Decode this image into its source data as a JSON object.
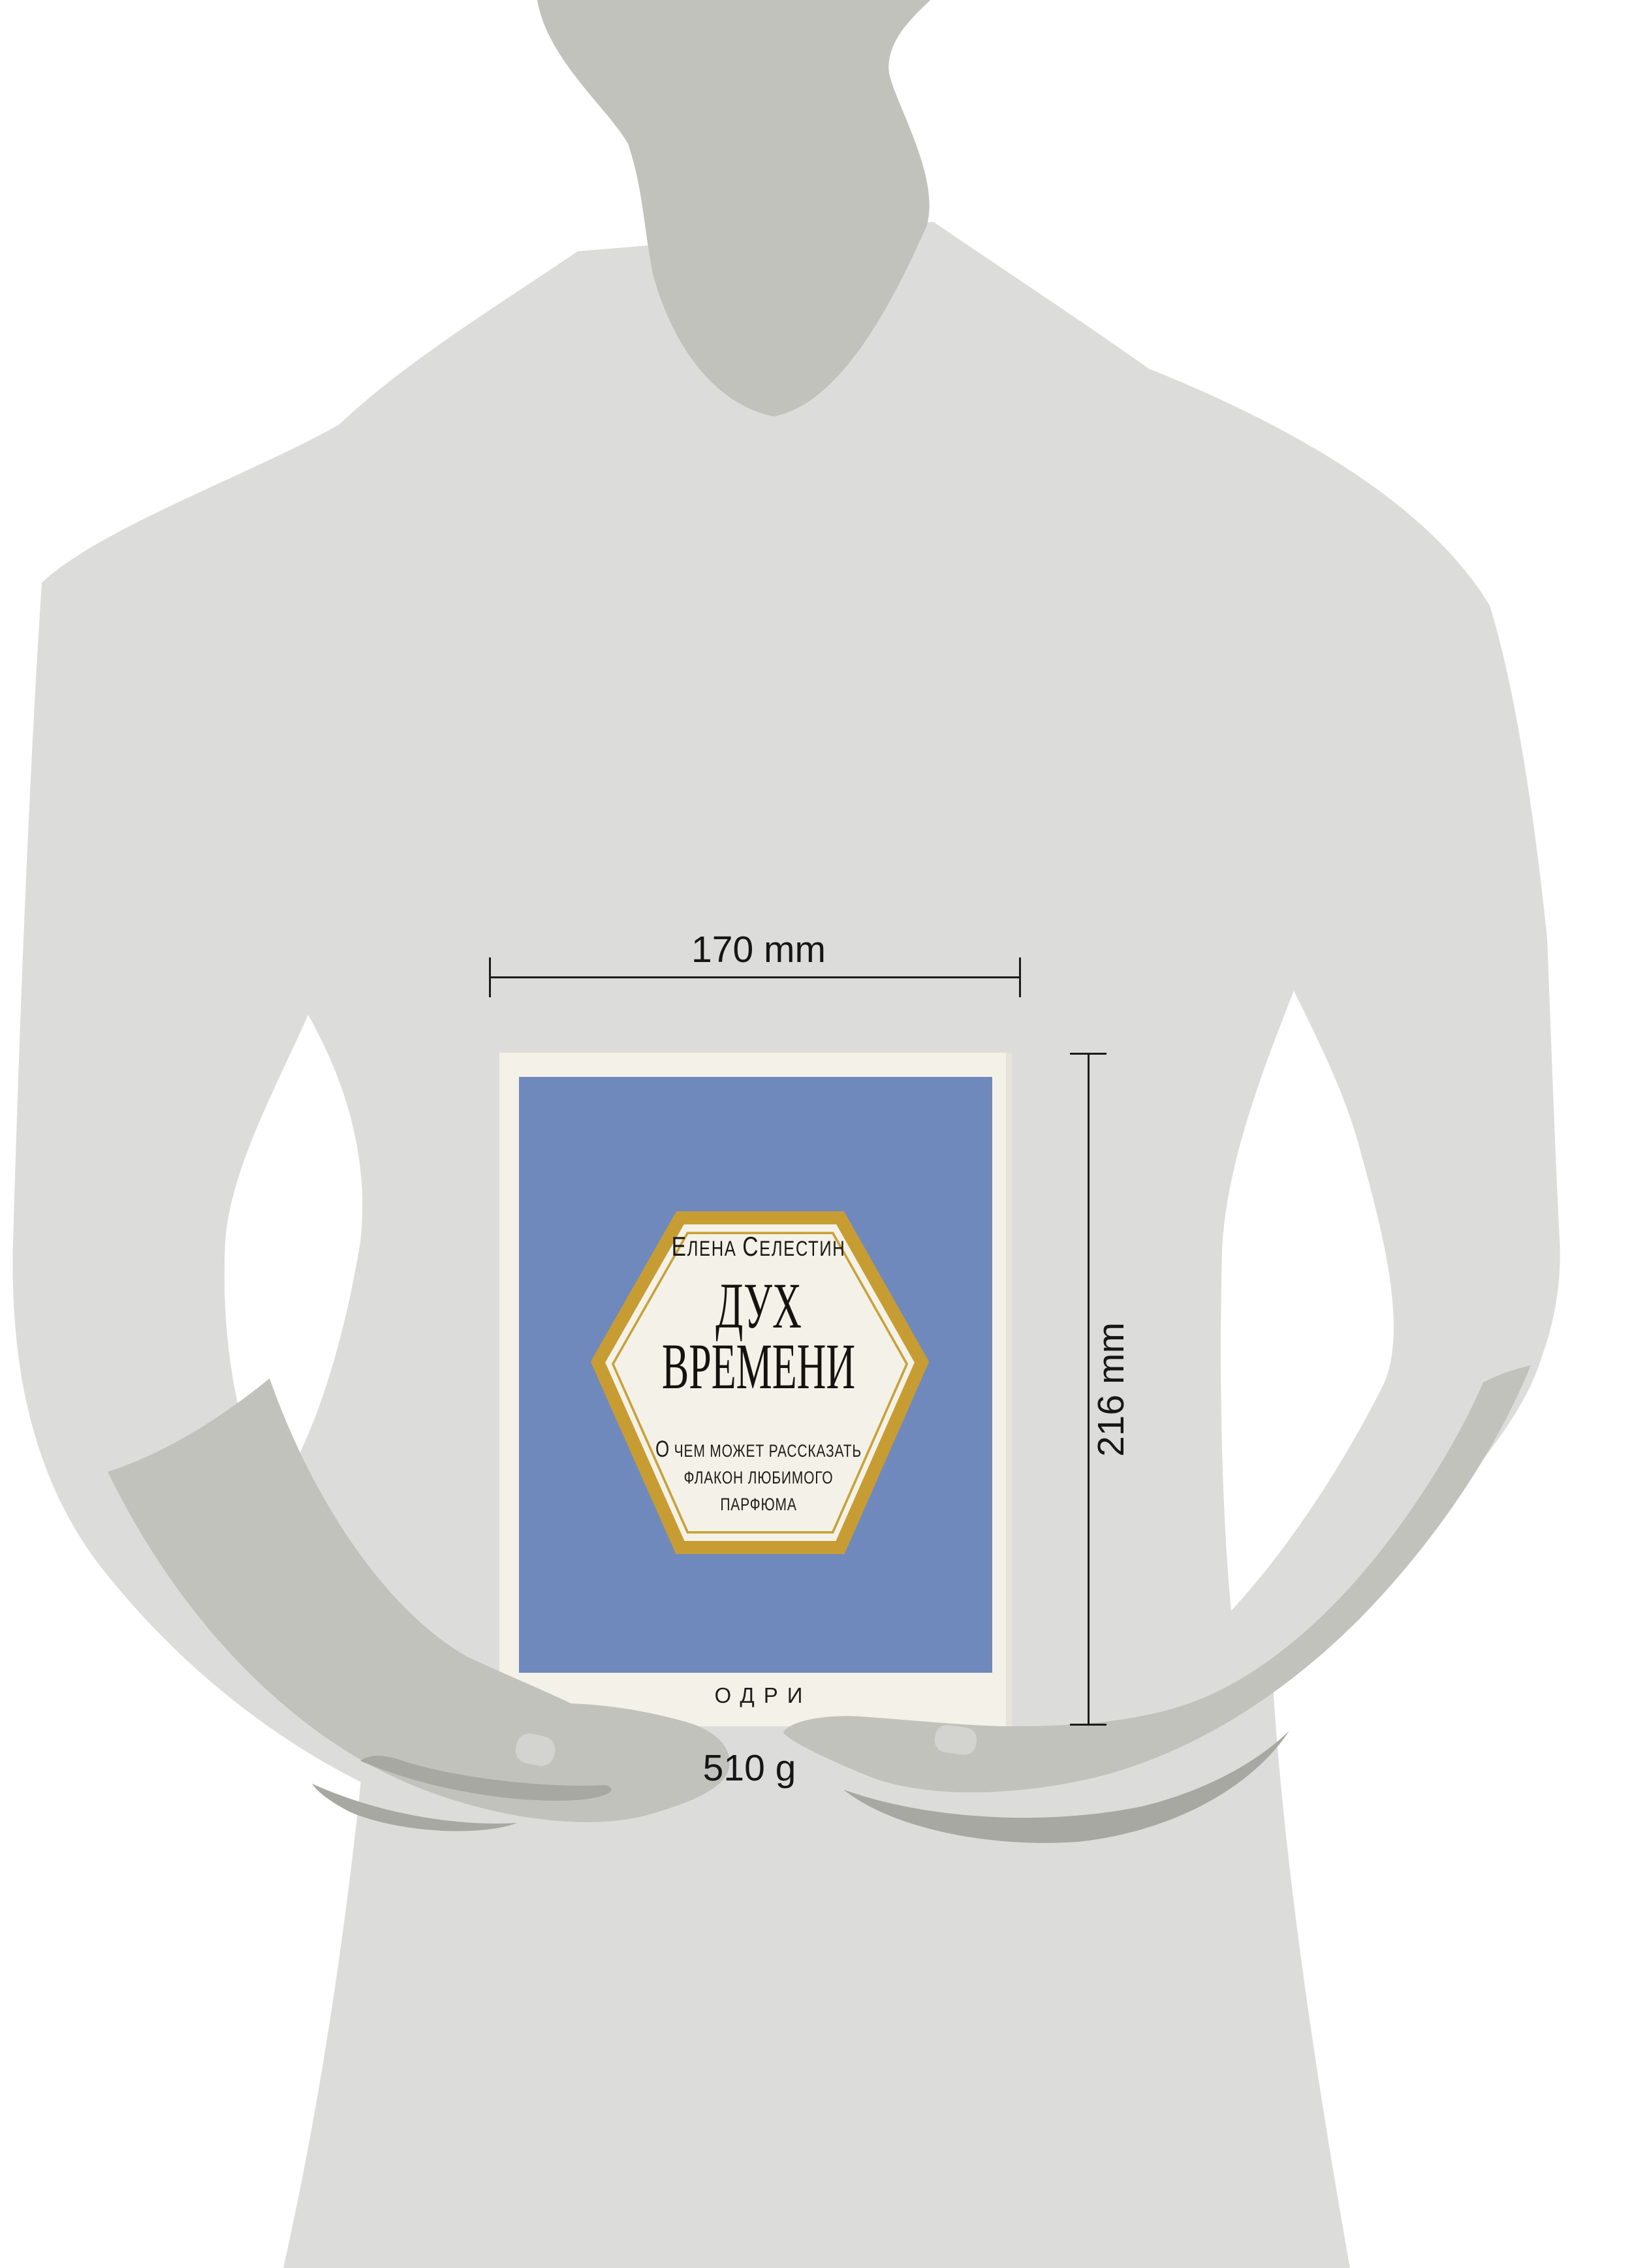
{
  "annotations": {
    "width_label": "170 mm",
    "height_label": "216 mm",
    "weight_label": "510 g"
  },
  "book": {
    "author": {
      "word1_initial": "Е",
      "word1_rest": "лена",
      "word2_initial": "С",
      "word2_rest": "елестин"
    },
    "title_line1": "ДУХ",
    "title_line2": "ВРЕМЕНИ",
    "subtitle": {
      "lead": "О",
      "line1_rest": " чем может рассказать",
      "line2": "флакон любимого",
      "line3": "парфюма"
    },
    "publisher": "ОДРИ",
    "colors": {
      "cover_blue": "#7089bd",
      "cover_cream": "#f4f2e8",
      "hexagon_gold": "#c79d33",
      "text_dark": "#17120e"
    }
  },
  "silhouette": {
    "body_color": "#dcdcda",
    "skin_color": "#c2c2bc",
    "shadow_color": "#a8a8a2",
    "nail_color": "#d3d3cf"
  }
}
